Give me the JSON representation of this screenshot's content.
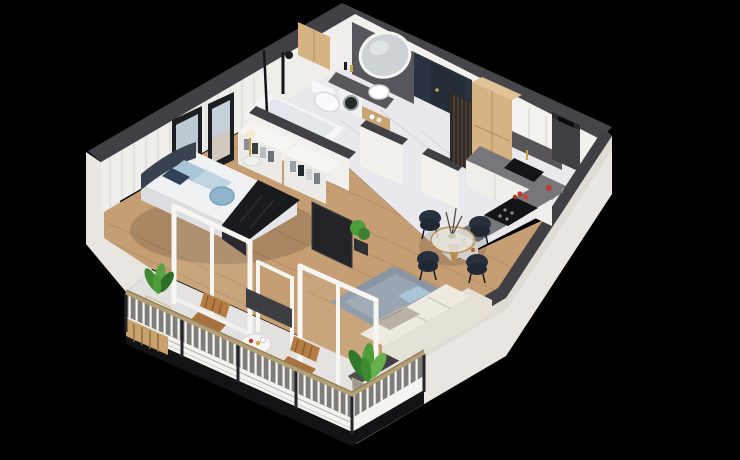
{
  "scene": {
    "title": "3D isometric cutaway floor plan render of a one-bedroom apartment with balcony",
    "type": "architectural-visualization",
    "view": "isometric-cutaway",
    "background": "#000000"
  },
  "palette": {
    "background_black": "#000000",
    "wall_cap": "#404045",
    "wall_white": "#f0eeea",
    "exterior_white": "#e9e6e1",
    "marble_floor": "#e9e9ed",
    "wood_floor": "#c59e74",
    "wood_cabinet": "#d6b382",
    "navy_accent": "#2a333f",
    "counter_gray": "#77767b",
    "appliance_black": "#131417",
    "rug_blue_gray": "#8a95a3",
    "sofa_cream": "#e6e1d7",
    "headboard_navy": "#3a4250",
    "throw_black": "#191a1e",
    "chair_navy": "#27303d",
    "plant_green": "#4f9c3b",
    "handrail_tan": "#b5a076",
    "pillow_blue": "#a9c6d8"
  },
  "rooms": {
    "bathroom": {
      "label": "Bathroom",
      "items": [
        "bathtub",
        "black shower set",
        "glass screen",
        "wall-hung toilet",
        "washing machine",
        "dark vanity counter",
        "white vessel sink",
        "large round mirror on dark panel",
        "wood cabinet",
        "towel shelf"
      ]
    },
    "bedroom": {
      "label": "Bedroom",
      "items": [
        "double bed",
        "curved navy headboard",
        "blue pillows",
        "round blue cushion",
        "black throw blanket",
        "two framed artworks",
        "bedside table",
        "gold lamp",
        "white paneled wall"
      ]
    },
    "wardrobe": {
      "label": "Wardrobe nook",
      "items": [
        "open white shelving",
        "folded clothes"
      ]
    },
    "hallway": {
      "label": "Hallway / entry",
      "items": [
        "dark entry door",
        "wood slat partition",
        "white partition walls",
        "marble floor"
      ]
    },
    "kitchen": {
      "label": "Kitchen",
      "items": [
        "tall wood cabinet",
        "white upper cabinets",
        "dark backsplash",
        "gray countertop",
        "black sink",
        "gold faucet",
        "induction cooktop",
        "chimney column",
        "red tomatoes",
        "red kettle"
      ]
    },
    "dining": {
      "label": "Dining area",
      "items": [
        "round glass table",
        "gold base",
        "vase with branches",
        "four navy chairs"
      ]
    },
    "living": {
      "label": "Living room",
      "items": [
        "cream sofa",
        "blue cushion",
        "gray throw",
        "blue-gray rug",
        "dark tv panel",
        "potted plant"
      ]
    },
    "balcony": {
      "label": "Balcony",
      "items": [
        "white baluster railing",
        "tan handrail",
        "two wooden lounge chairs",
        "round side table with macarons",
        "corner plant in gray pot",
        "plant in white pot",
        "dark planter wall stub",
        "wood slat fascia"
      ]
    }
  }
}
